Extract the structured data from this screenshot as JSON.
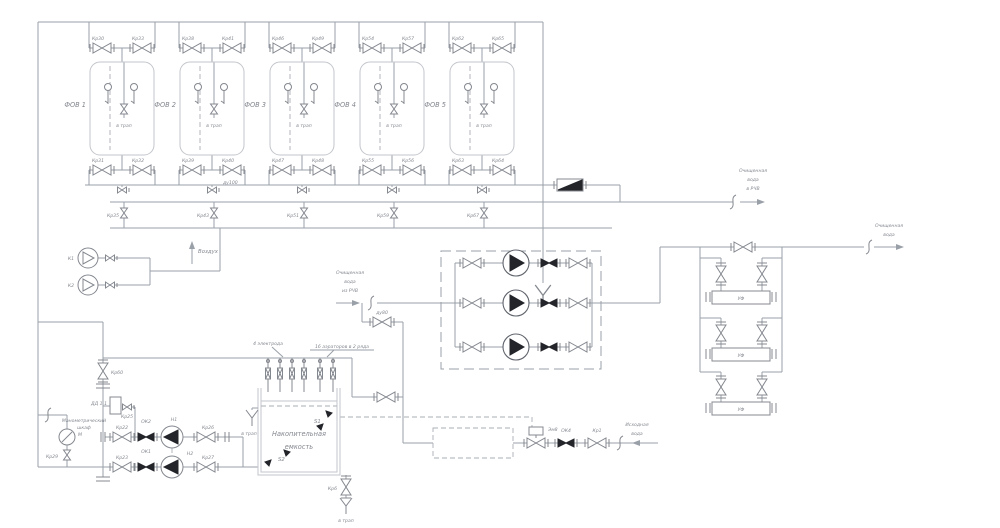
{
  "colors": {
    "line": "#9aa0a8",
    "light": "#c3c6cc",
    "dark": "#23252a",
    "text": "#83878f"
  },
  "filters": [
    {
      "name": "ФОВ 1",
      "valve_tl": "Кр30",
      "valve_tr": "Кр33",
      "valve_bl": "Кр31",
      "valve_br": "Кр32",
      "valve_drain": "Кр35",
      "drain_note": "в трап"
    },
    {
      "name": "ФОВ 2",
      "valve_tl": "Кр38",
      "valve_tr": "Кр41",
      "valve_bl": "Кр39",
      "valve_br": "Кр40",
      "valve_br_dn": "ду100",
      "valve_drain": "Кр43",
      "drain_note": "в трап"
    },
    {
      "name": "ФОВ 3",
      "valve_tl": "Кр46",
      "valve_tr": "Кр49",
      "valve_bl": "Кр47",
      "valve_br": "Кр48",
      "valve_drain": "Кр51",
      "drain_note": "в трап"
    },
    {
      "name": "ФОВ 4",
      "valve_tl": "Кр54",
      "valve_tr": "Кр57",
      "valve_bl": "Кр55",
      "valve_br": "Кр56",
      "valve_drain": "Кр59",
      "drain_note": "в трап"
    },
    {
      "name": "ФОВ 5",
      "valve_tl": "Кр62",
      "valve_tr": "Кр65",
      "valve_bl": "Кр63",
      "valve_br": "Кр64",
      "valve_drain": "Кр67",
      "drain_note": "в трап"
    }
  ],
  "air": {
    "compressor_1": "К1",
    "compressor_2": "К2",
    "label": "Воздух"
  },
  "streams": {
    "to_rchv": {
      "l1": "Очищенная",
      "l2": "вода",
      "l3": "в РЧВ"
    },
    "from_rchv": {
      "l1": "Очищенная",
      "l2": "вода",
      "l3": "из РЧВ"
    },
    "clean_out": {
      "l1": "Очищенная",
      "l2": "вода"
    },
    "source": {
      "l1": "Исходная",
      "l2": "вода"
    }
  },
  "uv_units": {
    "label": "УФ"
  },
  "feed_line": {
    "solenoid": "Эм8",
    "check_valve": "ОК4",
    "valve": "Кр1"
  },
  "tank": {
    "name_l1": "Накопительная",
    "name_l2": "емкость",
    "sensor_top": "S1",
    "sensor_bottom": "S2",
    "electrodes_note": "4 электрода",
    "aerators_note": "16 аэраторов в 2 ряда",
    "overflow_note": "в трап",
    "trap_note": "в трап",
    "drain_valve": "Кр6",
    "bypass_dn": "ду80"
  },
  "transfer_unit": {
    "pressure_sensor": "ДД 1.1",
    "sensor_valve": "Кр25",
    "cabinet_l1": "Манометрический",
    "cabinet_l2": "шкаф",
    "gauge": "М",
    "gauge_valve": "Кр29",
    "riser_valve": "Кр60",
    "row1": {
      "valve_in": "Кр22",
      "check": "ОК2",
      "pump": "Н1",
      "valve_out": "Кр26"
    },
    "row2": {
      "valve_in": "Кр23",
      "check": "ОК1",
      "pump": "Н2",
      "valve_out": "Кр27"
    }
  }
}
